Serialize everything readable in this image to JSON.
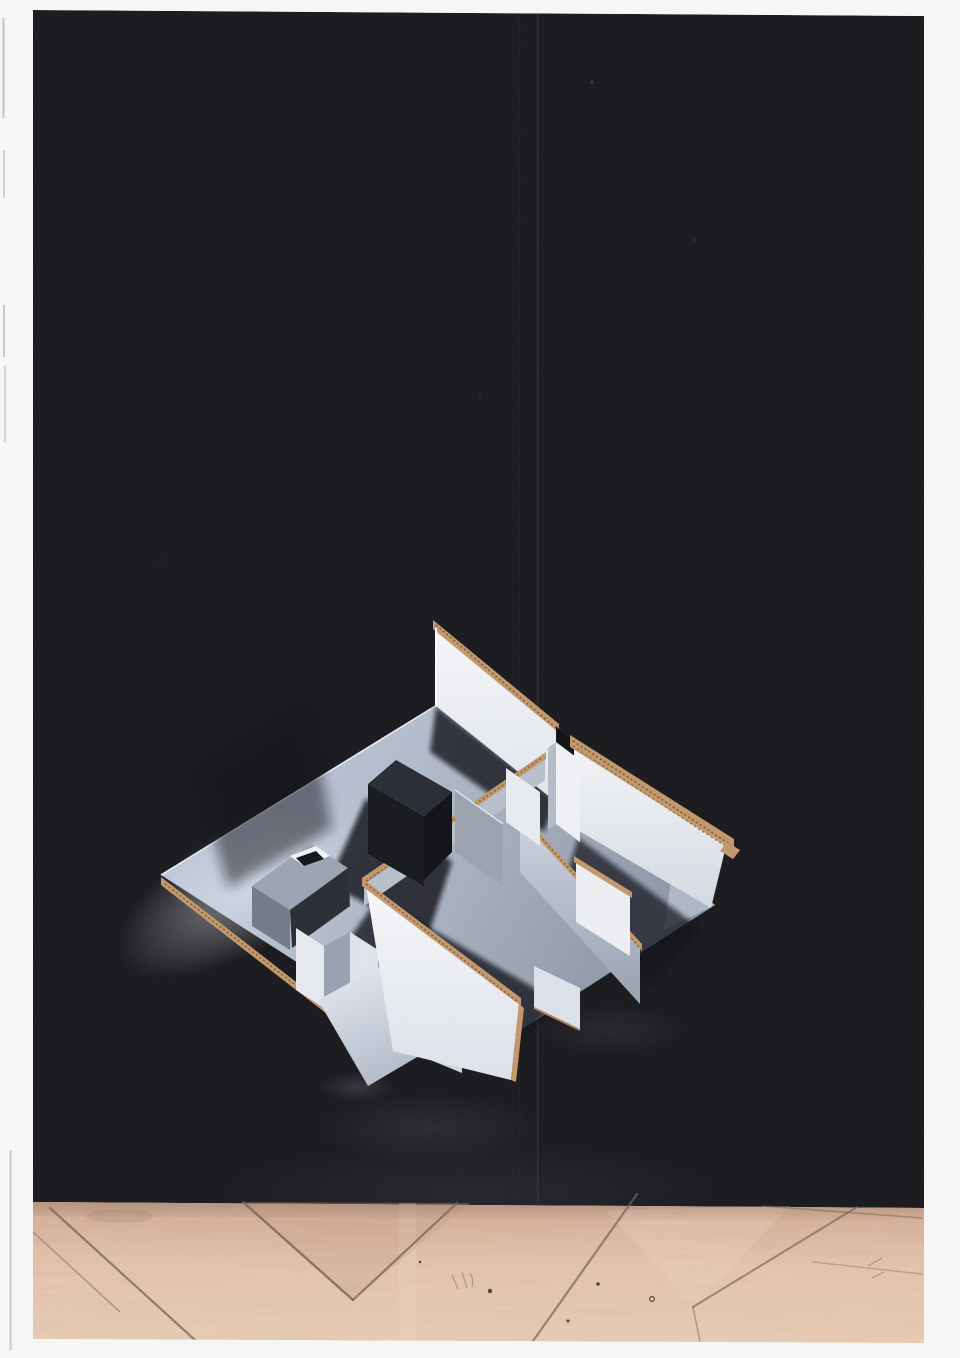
{
  "meta": {
    "media": "scanned photograph",
    "description": "Scanned photograph of a white cardboard architectural model of an apartment interior, shown from a high isometric viewpoint against a near-black backdrop, hovering above a pink-tan herringbone parquet wood floor. The model has a large blue-grey floor slab, long white card walls edged with corrugated cardboard, interior partitions, a small box volume with a roof opening, and a folded zigzag screen.",
    "aria_label": "Photograph of a cardboard architectural model on a black background above a herringbone parquet floor"
  },
  "photo": {
    "left_margin_px": 33,
    "top_margin_px": 10,
    "right_margin_px": 36,
    "bottom_margin_px": 15
  },
  "palette": {
    "page": "#f6f6f4",
    "backdrop": "#17171b",
    "backdrop_seam": "#232329",
    "model_floor_light": "#c9d1e1",
    "model_floor_shaded": "#8d96a6",
    "card_white": "#f3f5f8",
    "card_grey": "#aab2bf",
    "cardboard_tan": "#c2976a",
    "cardboard_shadow": "#7c5a36",
    "deep_shadow": "#0e1015",
    "wood_light": "#eccfb8",
    "wood_mid": "#d7ae96",
    "wood_seam": "#6e6156",
    "reflection_glow": "#9b8fae"
  }
}
